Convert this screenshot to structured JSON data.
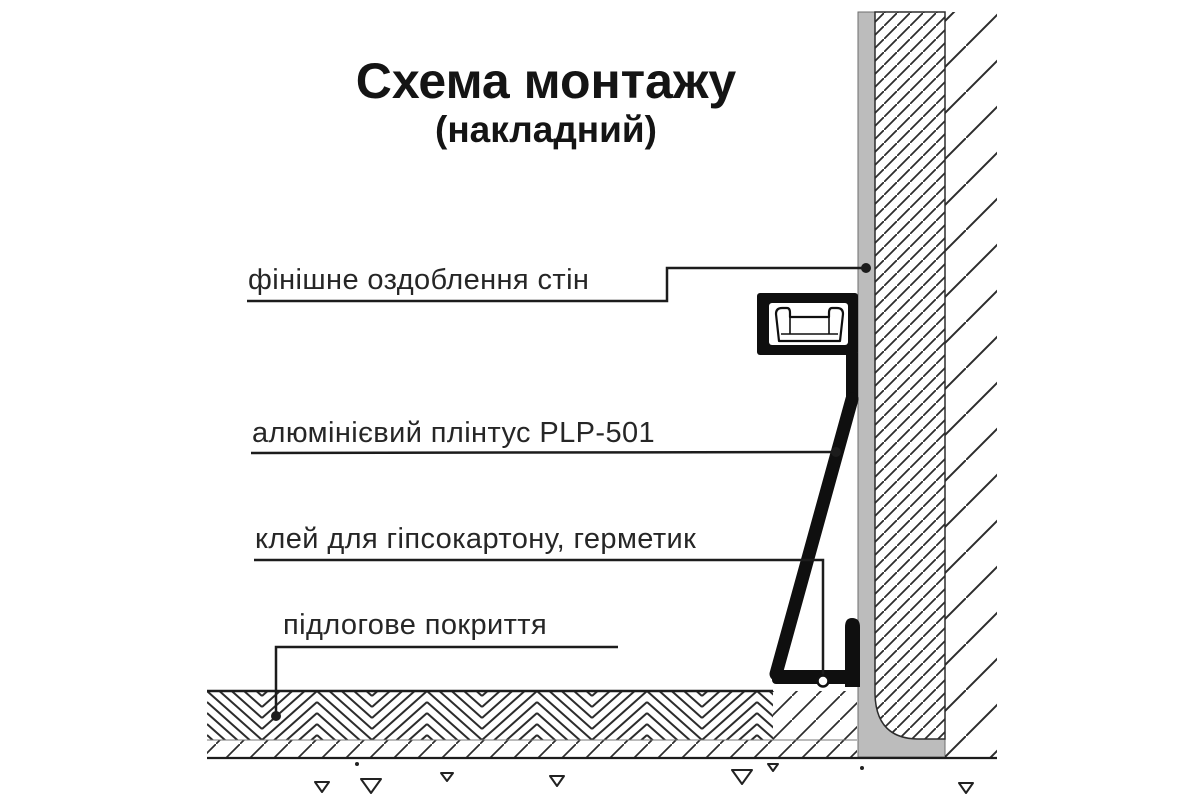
{
  "title": {
    "main": "Схема монтажу",
    "subtitle": "(накладний)"
  },
  "labels": {
    "wall_finish": "фінішне оздоблення стін",
    "plinth": "алюмінієвий плінтус PLP-501",
    "glue": "клей для гіпсокартону, герметик",
    "floor": "підлогове покриття"
  },
  "product_code": "PLP-501",
  "colors": {
    "background": "#ffffff",
    "ink": "#1c1c1c",
    "hatch_line": "#2c2c2c",
    "finish_gray": "#bcbcbc",
    "finish_gray_edge": "#6e6e6e",
    "profile_black": "#0f0f0f"
  }
}
